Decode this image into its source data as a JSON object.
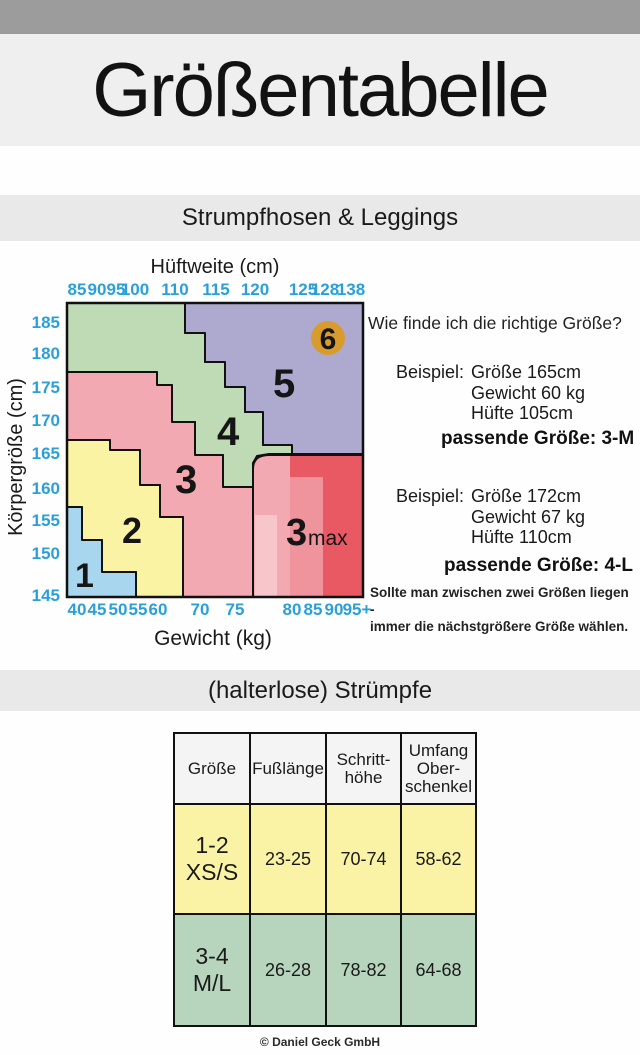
{
  "header": {
    "title": "Größentabelle"
  },
  "sections": [
    {
      "label": "Strumpfhosen & Leggings"
    },
    {
      "label": "(halterlose) Strümpfe"
    }
  ],
  "guide": {
    "heading": "Wie finde ich die richtige Größe?",
    "examples": [
      {
        "label": "Beispiel:",
        "lines": [
          "Größe 165cm",
          "Gewicht 60 kg",
          "Hüfte 105cm"
        ],
        "result": "passende Größe: 3-M"
      },
      {
        "label": "Beispiel:",
        "lines": [
          "Größe 172cm",
          "Gewicht 67 kg",
          "Hüfte 110cm"
        ],
        "result": "passende Größe: 4-L"
      }
    ],
    "note": [
      "Sollte man zwischen zwei Größen liegen -",
      "immer die nächstgrößere Größe wählen."
    ]
  },
  "chart_data": [
    {
      "type": "heatmap",
      "description": "Stepped size-region map: body height (y) vs weight (bottom x) vs hip width (top x); regions are sizes 1-6 plus 3max",
      "plot": {
        "w": 296,
        "h": 294,
        "border_color": "#111111"
      },
      "tick_color": "#2aa0db",
      "x_top_axis": {
        "label": "Hüftweite (cm)",
        "ticks": [
          {
            "t": "85",
            "x": 10
          },
          {
            "t": "90",
            "x": 30
          },
          {
            "t": "95",
            "x": 49
          },
          {
            "t": "100",
            "x": 68
          },
          {
            "t": "110",
            "x": 108
          },
          {
            "t": "115",
            "x": 149
          },
          {
            "t": "120",
            "x": 188
          },
          {
            "t": "125",
            "x": 236
          },
          {
            "t": "128",
            "x": 258
          },
          {
            "t": "138",
            "x": 284
          }
        ]
      },
      "x_bottom_axis": {
        "label": "Gewicht (kg)",
        "ticks": [
          {
            "t": "40",
            "x": 10
          },
          {
            "t": "45",
            "x": 30
          },
          {
            "t": "50",
            "x": 51
          },
          {
            "t": "55",
            "x": 71
          },
          {
            "t": "60",
            "x": 91
          },
          {
            "t": "70",
            "x": 133
          },
          {
            "t": "75",
            "x": 168
          },
          {
            "t": "80",
            "x": 225
          },
          {
            "t": "85",
            "x": 246
          },
          {
            "t": "90",
            "x": 267
          },
          {
            "t": "95+",
            "x": 290
          }
        ]
      },
      "y_axis": {
        "label": "Körpergröße (cm)",
        "ticks": [
          {
            "t": "185",
            "y": 19
          },
          {
            "t": "180",
            "y": 50
          },
          {
            "t": "175",
            "y": 84
          },
          {
            "t": "170",
            "y": 117
          },
          {
            "t": "165",
            "y": 150
          },
          {
            "t": "160",
            "y": 185
          },
          {
            "t": "155",
            "y": 217
          },
          {
            "t": "150",
            "y": 250
          },
          {
            "t": "145",
            "y": 292
          }
        ]
      },
      "regions": [
        {
          "id": "size-4",
          "size_label": "4",
          "color": "#bedbb6",
          "points": "0,0 118,0 118,30 138,30 138,59 158,59 158,84 178,84 178,109 196,109 196,142 225,142 225,151 202,151 190,153 186,160 186,184 156,184 156,152 128,152 128,119 105,119 105,82 90,82 90,69 0,69"
        },
        {
          "id": "size-5",
          "size_label": "5",
          "color": "#aeaacf",
          "points": "118,0 296,0 296,151 225,151 225,142 196,142 196,109 178,109 178,84 158,84 158,59 138,59 138,30 118,30"
        },
        {
          "id": "size-3",
          "size_label": "3",
          "color": "#f2a9b1",
          "points": "0,69 90,69 90,82 105,82 105,119 128,119 128,152 156,152 156,184 186,184 186,294 116,294 116,214 93,214 93,182 73,182 73,147 43,147 43,137 0,137"
        },
        {
          "id": "size-2",
          "size_label": "2",
          "color": "#faf3a3",
          "points": "0,137 43,137 43,147 73,147 73,182 93,182 93,214 116,214 116,294 69,294 69,269 35,269 35,237 15,237 15,204 0,204"
        },
        {
          "id": "size-1",
          "size_label": "1",
          "color": "#a8d6ee",
          "points": "0,204 15,204 15,237 35,237 35,269 69,269 69,294 0,294"
        },
        {
          "id": "size-3max",
          "size_label": "3max",
          "color": "#f2a9b1",
          "path": "M 186,294 L 186,166 Q 186,152 202,152 L 296,152 L 296,294 Z"
        }
      ],
      "shade_overlays": [
        {
          "color": "#f7c6ca",
          "x": 188,
          "y": 212,
          "w": 22,
          "h": 81
        },
        {
          "color": "#ef949d",
          "x": 223,
          "y": 174,
          "w": 33,
          "h": 119
        },
        {
          "color": "#e85964",
          "points": "223,153 295,153 295,293 256,293 256,174 223,174"
        }
      ],
      "labels": [
        {
          "text": "1",
          "x": 8,
          "y": 284,
          "size": 34
        },
        {
          "text": "2",
          "x": 55,
          "y": 240,
          "size": 36
        },
        {
          "text": "3",
          "x": 108,
          "y": 190,
          "size": 40
        },
        {
          "text": "4",
          "x": 150,
          "y": 142,
          "size": 40
        },
        {
          "text": "5",
          "x": 206,
          "y": 94,
          "size": 40
        },
        {
          "text": "3",
          "x": 219,
          "y": 242,
          "size": 38
        },
        {
          "text": "max",
          "x": 241,
          "y": 242,
          "size": 21,
          "weight": "normal"
        }
      ],
      "badge": {
        "label": "6",
        "cx": 261,
        "cy": 35,
        "r": 17,
        "color": "#d89b2e"
      }
    },
    {
      "type": "table",
      "headers": [
        [
          "Größe"
        ],
        [
          "Fußlänge"
        ],
        [
          "Schritt-",
          "höhe"
        ],
        [
          "Umfang",
          "Ober-",
          "schenkel"
        ]
      ],
      "rows": [
        {
          "size_lines": [
            "1-2",
            "XS/S"
          ],
          "cells": [
            "23-25",
            "70-74",
            "58-62"
          ],
          "row_color": "#faf3a6"
        },
        {
          "size_lines": [
            "3-4",
            "M/L"
          ],
          "cells": [
            "26-28",
            "78-82",
            "64-68"
          ],
          "row_color": "#b7d5bc"
        }
      ]
    }
  ],
  "footer": {
    "copyright": "© Daniel Geck GmbH"
  }
}
